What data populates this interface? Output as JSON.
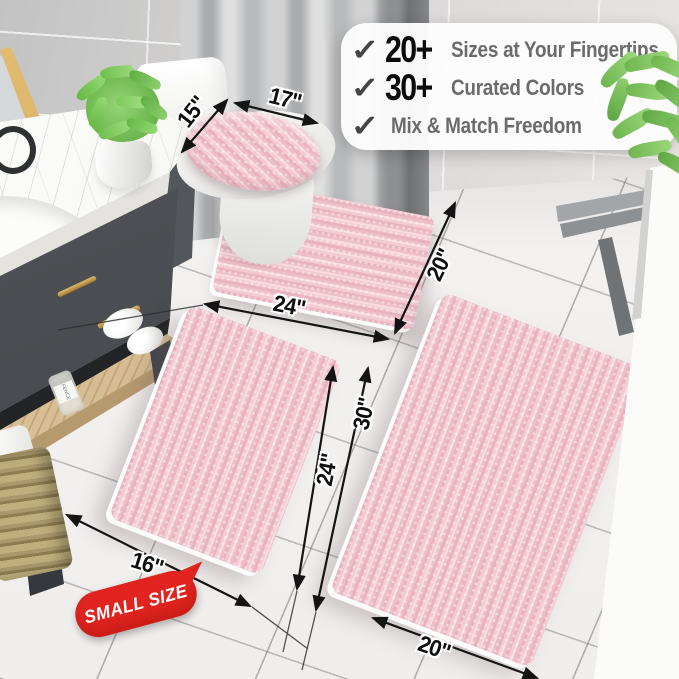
{
  "overlay_card": {
    "check_icon": "✓",
    "rows": [
      {
        "number": "20+",
        "text": "Sizes at Your Fingertips"
      },
      {
        "number": "30+",
        "text": "Curated Colors"
      },
      {
        "number": "",
        "text": "Mix & Match Freedom"
      }
    ]
  },
  "measurements": {
    "lid_length": "17\"",
    "lid_width": "15\"",
    "contour_width": "24\"",
    "contour_depth": "20\"",
    "small_rug_width": "16\"",
    "small_rug_length": "24\"",
    "large_rug_side": "30\"",
    "large_rug_bottom": "20\""
  },
  "badge": {
    "label": "SMALL SIZE"
  },
  "jar": {
    "label": "FENCE"
  },
  "colors": {
    "rug_pink": "#f3cbd3",
    "badge_red": "#e1241f",
    "accent_gold": "#c9a254",
    "number_black": "#0c0c0c",
    "caption_gray": "#6b6b6b"
  }
}
